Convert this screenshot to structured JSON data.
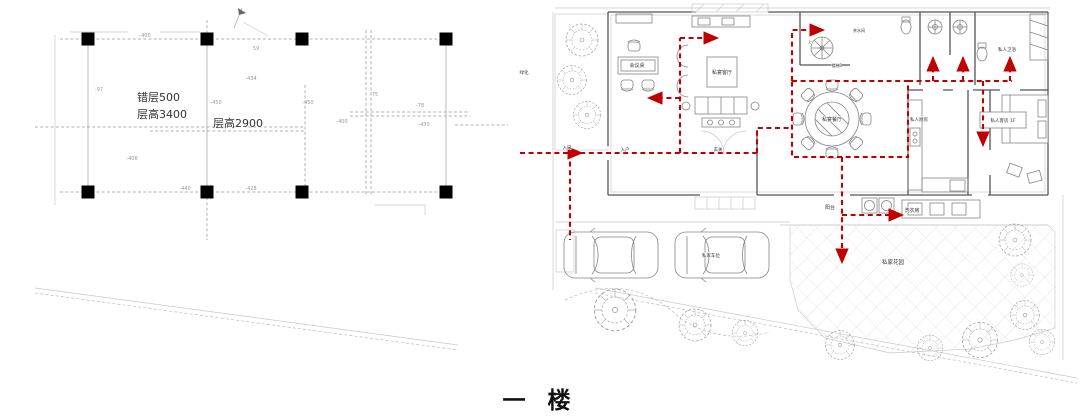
{
  "title": "一 楼",
  "colors": {
    "route": "#c00000",
    "columns": "#000000",
    "walls": "#555555",
    "furniture": "#858585",
    "dimensions": "#999999",
    "text": "#333333",
    "title": "#111111"
  },
  "left_plan": {
    "labels": [
      {
        "t": "错层500",
        "x": 137,
        "y": 101,
        "s": 11,
        "cls": "start",
        "n": "split-level-label"
      },
      {
        "t": "层高3400",
        "x": 137,
        "y": 118,
        "s": 11,
        "cls": "start",
        "n": "ceiling-height-label"
      },
      {
        "t": "层高2900",
        "x": 213,
        "y": 127,
        "s": 11,
        "cls": "start",
        "n": "ceiling-height-label"
      },
      {
        "t": "-400",
        "x": 145,
        "y": 37,
        "s": 5,
        "cls": "dimc",
        "n": "dim-label"
      },
      {
        "t": "59",
        "x": 256,
        "y": 50,
        "s": 5,
        "cls": "dimc",
        "n": "dim-label"
      },
      {
        "t": "-434",
        "x": 251,
        "y": 80,
        "s": 5,
        "cls": "dimc",
        "n": "dim-label"
      },
      {
        "t": "-450",
        "x": 216,
        "y": 104,
        "s": 5,
        "cls": "dimc",
        "n": "dim-label"
      },
      {
        "t": "-97",
        "x": 99,
        "y": 91,
        "s": 5,
        "cls": "dimc",
        "n": "dim-label"
      },
      {
        "t": "-450",
        "x": 308,
        "y": 104,
        "s": 5,
        "cls": "dimc",
        "n": "dim-label"
      },
      {
        "t": "-75",
        "x": 374,
        "y": 96,
        "s": 5,
        "cls": "dimc",
        "n": "dim-label"
      },
      {
        "t": "-78",
        "x": 420,
        "y": 107,
        "s": 5,
        "cls": "dimc",
        "n": "dim-label"
      },
      {
        "t": "-400",
        "x": 342,
        "y": 123,
        "s": 5,
        "cls": "dimc",
        "n": "dim-label"
      },
      {
        "t": "-430",
        "x": 424,
        "y": 126,
        "s": 5,
        "cls": "dimc",
        "n": "dim-label"
      },
      {
        "t": "-406",
        "x": 132,
        "y": 160,
        "s": 5,
        "cls": "dimc",
        "n": "dim-label"
      },
      {
        "t": "-440",
        "x": 185,
        "y": 190,
        "s": 5,
        "cls": "dimc",
        "n": "dim-label"
      },
      {
        "t": "-428",
        "x": 251,
        "y": 190,
        "s": 5,
        "cls": "dimc",
        "n": "dim-label"
      }
    ]
  },
  "right_plan": {
    "labels": [
      {
        "t": "会议桌",
        "x": 127,
        "y": 67,
        "s": 5,
        "n": "meeting-table-label"
      },
      {
        "t": "私宴客厅",
        "x": 212,
        "y": 74,
        "s": 5,
        "n": "living-room-label"
      },
      {
        "t": "私宴餐厅",
        "x": 322,
        "y": 121,
        "s": 5,
        "n": "dining-room-label"
      },
      {
        "t": "私人厨房",
        "x": 409,
        "y": 121,
        "s": 4.5,
        "n": "kitchen-label"
      },
      {
        "t": "私人卫浴",
        "x": 497,
        "y": 51,
        "s": 4.5,
        "n": "bathroom-label"
      },
      {
        "t": "私人客房 1F",
        "x": 493,
        "y": 122,
        "s": 4.5,
        "n": "guest-room-label"
      },
      {
        "t": "楼梯1",
        "x": 327,
        "y": 67,
        "s": 4,
        "n": "stair-label"
      },
      {
        "t": "茶水间",
        "x": 349,
        "y": 32,
        "s": 4,
        "n": "pantry-label"
      },
      {
        "t": "上",
        "x": 300,
        "y": 43,
        "s": 4,
        "n": "stair-up-label"
      },
      {
        "t": "阳台",
        "x": 320,
        "y": 209,
        "s": 5,
        "n": "balcony-label"
      },
      {
        "t": "洗衣房",
        "x": 402,
        "y": 212,
        "s": 5,
        "n": "laundry-label"
      },
      {
        "t": "私家花园",
        "x": 383,
        "y": 264,
        "s": 5.5,
        "n": "garden-label"
      },
      {
        "t": "私家车位",
        "x": 201,
        "y": 257,
        "s": 4.5,
        "n": "parking-label"
      },
      {
        "t": "入口",
        "x": 57,
        "y": 149,
        "s": 4.5,
        "n": "entry-label"
      },
      {
        "t": "入户",
        "x": 115,
        "y": 151,
        "s": 4.5,
        "n": "entry-hall-label"
      },
      {
        "t": "玄关",
        "x": 208,
        "y": 151,
        "s": 4.5,
        "n": "foyer-label"
      },
      {
        "t": "绿化",
        "x": 14,
        "y": 74,
        "s": 4.5,
        "n": "greenery-label"
      }
    ]
  }
}
